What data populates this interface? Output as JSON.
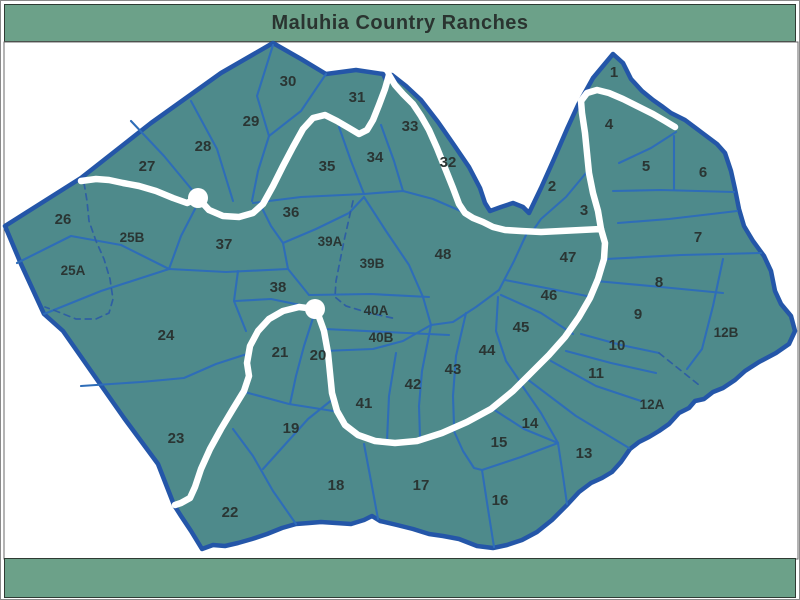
{
  "title": "Maluhia Country Ranches",
  "map": {
    "colors": {
      "band": "#6CA189",
      "band_border": "#2e3b33",
      "title": "#2A3430",
      "land": "#4E8A8B",
      "parcel": "#2E6DB8",
      "boundary": "#2456A8",
      "road": "#FFFFFF",
      "dashed": "#2E5FA3",
      "label": "#2A3533"
    },
    "lots": [
      {
        "id": "1",
        "x": 613,
        "y": 76
      },
      {
        "id": "2",
        "x": 551,
        "y": 190
      },
      {
        "id": "3",
        "x": 583,
        "y": 214
      },
      {
        "id": "4",
        "x": 608,
        "y": 128
      },
      {
        "id": "5",
        "x": 645,
        "y": 170
      },
      {
        "id": "6",
        "x": 702,
        "y": 176
      },
      {
        "id": "7",
        "x": 697,
        "y": 241
      },
      {
        "id": "8",
        "x": 658,
        "y": 286
      },
      {
        "id": "9",
        "x": 637,
        "y": 318
      },
      {
        "id": "10",
        "x": 616,
        "y": 349
      },
      {
        "id": "11",
        "x": 595,
        "y": 377
      },
      {
        "id": "12A",
        "x": 651,
        "y": 408
      },
      {
        "id": "12B",
        "x": 725,
        "y": 336
      },
      {
        "id": "13",
        "x": 583,
        "y": 457
      },
      {
        "id": "14",
        "x": 529,
        "y": 427
      },
      {
        "id": "15",
        "x": 498,
        "y": 446
      },
      {
        "id": "16",
        "x": 499,
        "y": 504
      },
      {
        "id": "17",
        "x": 420,
        "y": 489
      },
      {
        "id": "18",
        "x": 335,
        "y": 489
      },
      {
        "id": "19",
        "x": 290,
        "y": 432
      },
      {
        "id": "20",
        "x": 317,
        "y": 359
      },
      {
        "id": "21",
        "x": 279,
        "y": 356
      },
      {
        "id": "22",
        "x": 229,
        "y": 516
      },
      {
        "id": "23",
        "x": 175,
        "y": 442
      },
      {
        "id": "24",
        "x": 165,
        "y": 339
      },
      {
        "id": "25A",
        "x": 72,
        "y": 274
      },
      {
        "id": "25B",
        "x": 131,
        "y": 241
      },
      {
        "id": "26",
        "x": 62,
        "y": 223
      },
      {
        "id": "27",
        "x": 146,
        "y": 170
      },
      {
        "id": "28",
        "x": 202,
        "y": 150
      },
      {
        "id": "29",
        "x": 250,
        "y": 125
      },
      {
        "id": "30",
        "x": 287,
        "y": 85
      },
      {
        "id": "31",
        "x": 356,
        "y": 101
      },
      {
        "id": "32",
        "x": 447,
        "y": 166
      },
      {
        "id": "33",
        "x": 409,
        "y": 130
      },
      {
        "id": "34",
        "x": 374,
        "y": 161
      },
      {
        "id": "35",
        "x": 326,
        "y": 170
      },
      {
        "id": "36",
        "x": 290,
        "y": 216
      },
      {
        "id": "37",
        "x": 223,
        "y": 248
      },
      {
        "id": "38",
        "x": 277,
        "y": 291
      },
      {
        "id": "39A",
        "x": 329,
        "y": 245
      },
      {
        "id": "39B",
        "x": 371,
        "y": 267
      },
      {
        "id": "40A",
        "x": 375,
        "y": 314
      },
      {
        "id": "40B",
        "x": 380,
        "y": 341
      },
      {
        "id": "41",
        "x": 363,
        "y": 407
      },
      {
        "id": "42",
        "x": 412,
        "y": 388
      },
      {
        "id": "43",
        "x": 452,
        "y": 373
      },
      {
        "id": "44",
        "x": 486,
        "y": 354
      },
      {
        "id": "45",
        "x": 520,
        "y": 331
      },
      {
        "id": "46",
        "x": 548,
        "y": 299
      },
      {
        "id": "47",
        "x": 567,
        "y": 261
      },
      {
        "id": "48",
        "x": 442,
        "y": 258
      }
    ]
  }
}
